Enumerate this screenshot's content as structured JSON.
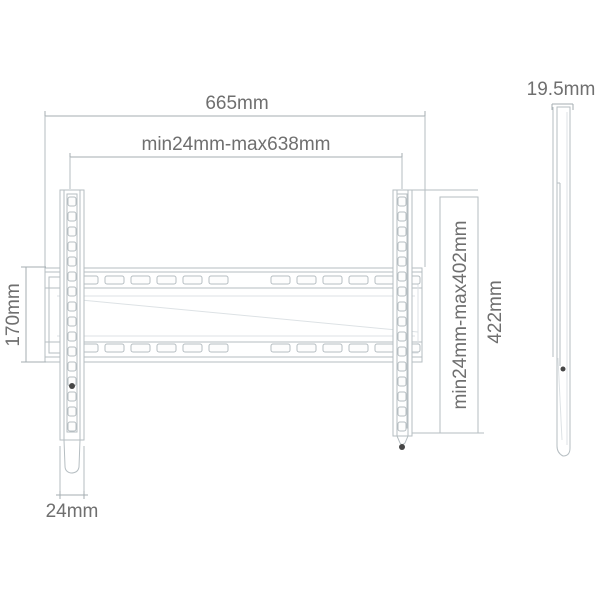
{
  "meta": {
    "description": "Technical dimension diagram of a fixed TV wall mount bracket: front view with wall plate and two vertical VESA rails, plus a thin side profile view"
  },
  "front_view": {
    "overall_width": "665mm",
    "horizontal_vesa_range": "min24mm-max638mm",
    "plate_height": "170mm",
    "rail_width": "24mm",
    "vertical_vesa_range": "min24mm-max402mm",
    "rail_height": "422mm"
  },
  "side_view": {
    "profile_depth": "19.5mm"
  },
  "colors": {
    "line": "#b6bec2",
    "line_dark": "#a4adb2",
    "text": "#6f6f6f",
    "screw": "#474747",
    "background": "#ffffff"
  }
}
